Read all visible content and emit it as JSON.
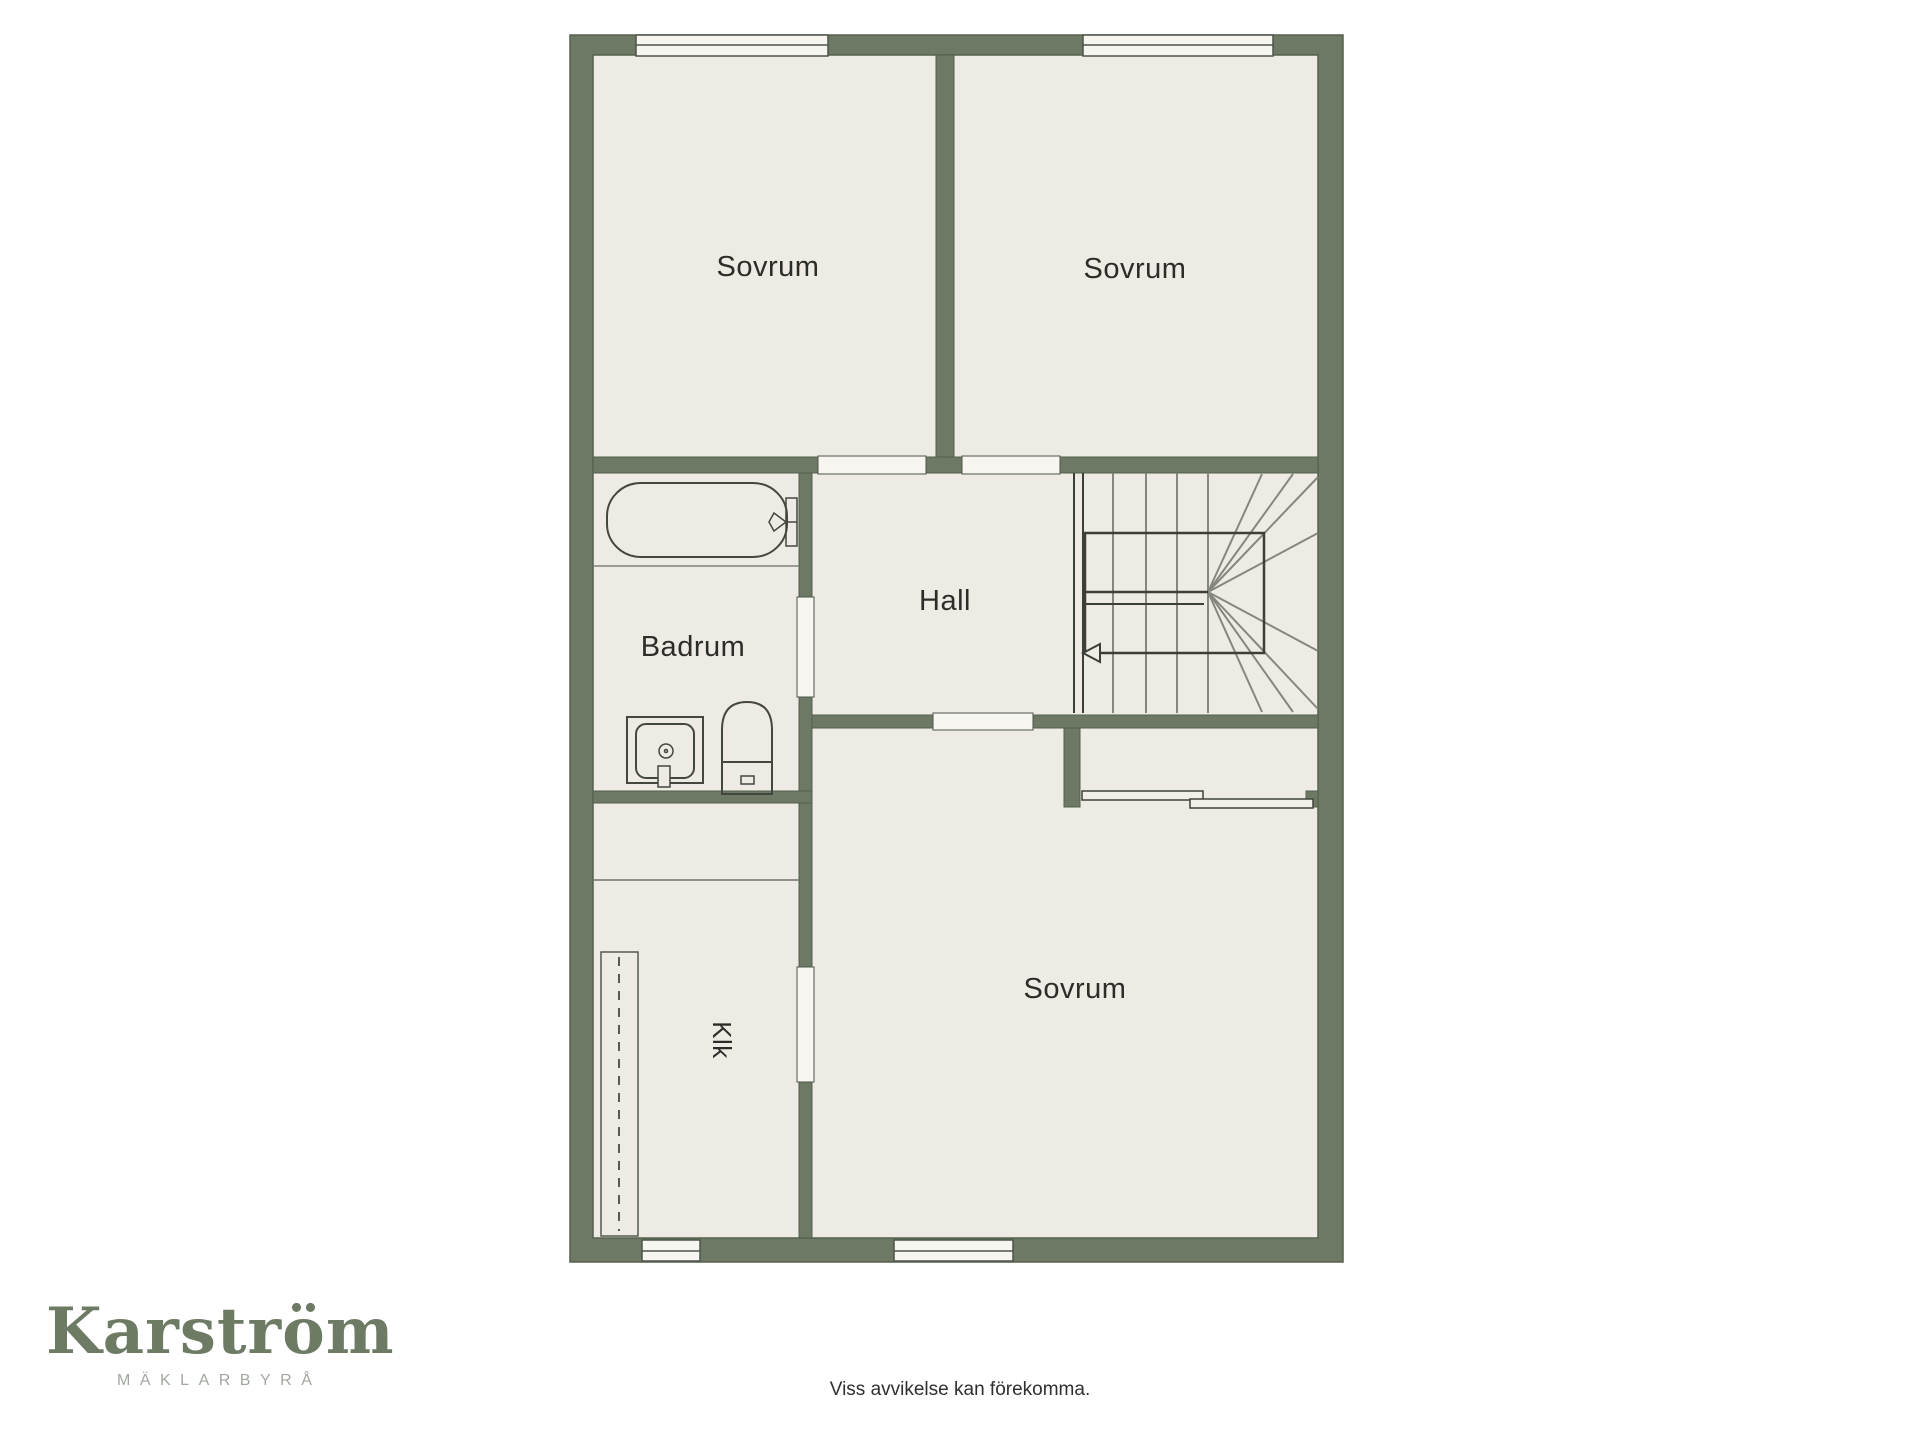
{
  "floor_plan": {
    "wall_color": "#6d7964",
    "room_fill": "#eeebe4",
    "window_fill": "#f7f5ef",
    "rooms": [
      {
        "id": "sovrum-top-left",
        "label": "Sovrum"
      },
      {
        "id": "sovrum-top-right",
        "label": "Sovrum"
      },
      {
        "id": "badrum",
        "label": "Badrum"
      },
      {
        "id": "hall",
        "label": "Hall"
      },
      {
        "id": "sovrum-bottom",
        "label": "Sovrum"
      },
      {
        "id": "klk",
        "label": "Klk"
      }
    ],
    "fixtures": [
      "bathtub-icon",
      "sink-icon",
      "toilet-icon",
      "staircase",
      "wardrobe-icon",
      "sliding-closet-icon"
    ]
  },
  "branding": {
    "name": "Karström",
    "tagline": "MÄKLARBYRÅ",
    "name_color": "#6d7a64",
    "tagline_color": "#a2a7a0"
  },
  "footer": {
    "disclaimer": "Viss avvikelse kan förekomma."
  }
}
